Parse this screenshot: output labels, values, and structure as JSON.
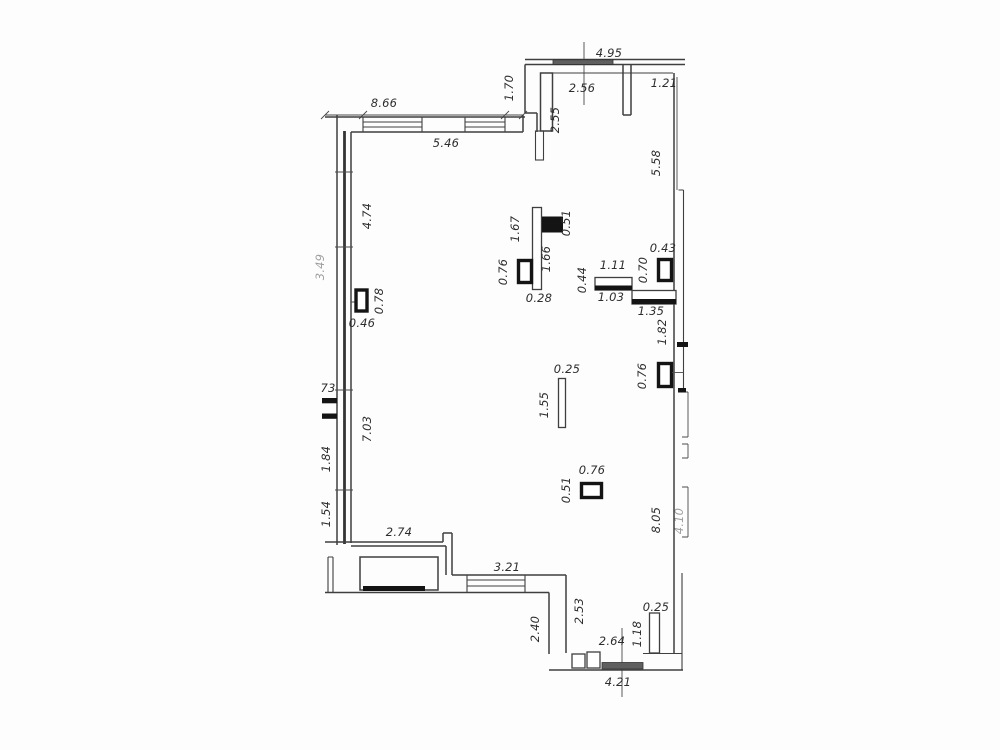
{
  "figure": {
    "kind": "floor-plan-drawing",
    "units": "meters",
    "background": "#fdfdfd"
  },
  "colors": {
    "wall_line": "#3f3f3f",
    "solid_fill": "#141414",
    "window_hatch": "#5f5f5f",
    "label_text": "#2d2d2d"
  },
  "labels": [
    {
      "text": "4.95",
      "x": 609,
      "y": 57,
      "r": 0,
      "area": "top"
    },
    {
      "text": "2.56",
      "x": 582,
      "y": 92,
      "r": 0,
      "area": "top"
    },
    {
      "text": "1.70",
      "x": 513,
      "y": 88,
      "r": -90,
      "area": "top"
    },
    {
      "text": "2.55",
      "x": 559,
      "y": 120,
      "r": -90,
      "area": "top"
    },
    {
      "text": "1.21",
      "x": 664,
      "y": 87,
      "r": 0,
      "area": "top-right"
    },
    {
      "text": "5.58",
      "x": 660,
      "y": 163,
      "r": -90,
      "area": "right"
    },
    {
      "text": "8.66",
      "x": 384,
      "y": 107,
      "r": 0,
      "area": "north-wall"
    },
    {
      "text": "5.46",
      "x": 446,
      "y": 147,
      "r": 0,
      "area": "north-wall"
    },
    {
      "text": "4.74",
      "x": 371,
      "y": 216,
      "r": -90,
      "area": "west-wall"
    },
    {
      "text": "1.67",
      "x": 519,
      "y": 229,
      "r": -90,
      "area": "center-partition"
    },
    {
      "text": "0.51",
      "x": 570,
      "y": 223,
      "r": -90,
      "area": "center-partition"
    },
    {
      "text": "1.66",
      "x": 550,
      "y": 259,
      "r": -90,
      "area": "center-partition"
    },
    {
      "text": "0.76",
      "x": 507,
      "y": 272,
      "r": -90,
      "area": "center-partition"
    },
    {
      "text": "0.28",
      "x": 539,
      "y": 302,
      "r": 0,
      "area": "center-partition"
    },
    {
      "text": "0.78",
      "x": 383,
      "y": 301,
      "r": -90,
      "area": "west-column"
    },
    {
      "text": "0.46",
      "x": 362,
      "y": 327,
      "r": 0,
      "area": "west-column"
    },
    {
      "text": "0.44",
      "x": 586,
      "y": 280,
      "r": -90,
      "area": "east-partition"
    },
    {
      "text": "1.11",
      "x": 613,
      "y": 269,
      "r": 0,
      "area": "east-partition"
    },
    {
      "text": "1.03",
      "x": 611,
      "y": 301,
      "r": 0,
      "area": "east-partition"
    },
    {
      "text": "0.70",
      "x": 647,
      "y": 270,
      "r": -90,
      "area": "east-partition"
    },
    {
      "text": "0.43",
      "x": 663,
      "y": 252,
      "r": 0,
      "area": "east-partition"
    },
    {
      "text": "1.35",
      "x": 651,
      "y": 315,
      "r": 0,
      "area": "east-partition"
    },
    {
      "text": "1.82",
      "x": 666,
      "y": 332,
      "r": -90,
      "area": "east-wall"
    },
    {
      "text": "0.76",
      "x": 646,
      "y": 376,
      "r": -90,
      "area": "east-column"
    },
    {
      "text": "0.25",
      "x": 567,
      "y": 373,
      "r": 0,
      "area": "center-pier"
    },
    {
      "text": "1.55",
      "x": 548,
      "y": 405,
      "r": -90,
      "area": "center-pier"
    },
    {
      "text": "0.76",
      "x": 592,
      "y": 474,
      "r": 0,
      "area": "center-column"
    },
    {
      "text": "0.51",
      "x": 570,
      "y": 490,
      "r": -90,
      "area": "center-column"
    },
    {
      "text": "73",
      "x": 328,
      "y": 392,
      "r": 0,
      "area": "west-wall"
    },
    {
      "text": "1.84",
      "x": 330,
      "y": 459,
      "r": -90,
      "area": "west-wall"
    },
    {
      "text": "7.03",
      "x": 371,
      "y": 429,
      "r": -90,
      "area": "west-wall"
    },
    {
      "text": "1.54",
      "x": 330,
      "y": 514,
      "r": -90,
      "area": "west-wall"
    },
    {
      "text": "2.74",
      "x": 399,
      "y": 536,
      "r": 0,
      "area": "south-wall"
    },
    {
      "text": "3.21",
      "x": 507,
      "y": 571,
      "r": 0,
      "area": "south-window"
    },
    {
      "text": "2.40",
      "x": 539,
      "y": 629,
      "r": -90,
      "area": "south-wall"
    },
    {
      "text": "2.53",
      "x": 583,
      "y": 611,
      "r": -90,
      "area": "south-wall"
    },
    {
      "text": "2.64",
      "x": 612,
      "y": 645,
      "r": 0,
      "area": "south-door"
    },
    {
      "text": "1.18",
      "x": 641,
      "y": 634,
      "r": -90,
      "area": "south-pier"
    },
    {
      "text": "0.25",
      "x": 656,
      "y": 611,
      "r": 0,
      "area": "south-pier"
    },
    {
      "text": "4.21",
      "x": 618,
      "y": 686,
      "r": 0,
      "area": "south-wall"
    },
    {
      "text": "8.05",
      "x": 660,
      "y": 520,
      "r": -90,
      "area": "east-wall"
    },
    {
      "text": "4.10",
      "x": 683,
      "y": 521,
      "r": -90,
      "area": "east-edge",
      "faint": true
    },
    {
      "text": "3.49",
      "x": 324,
      "y": 267,
      "r": -90,
      "area": "west-edge",
      "faint": true
    }
  ]
}
